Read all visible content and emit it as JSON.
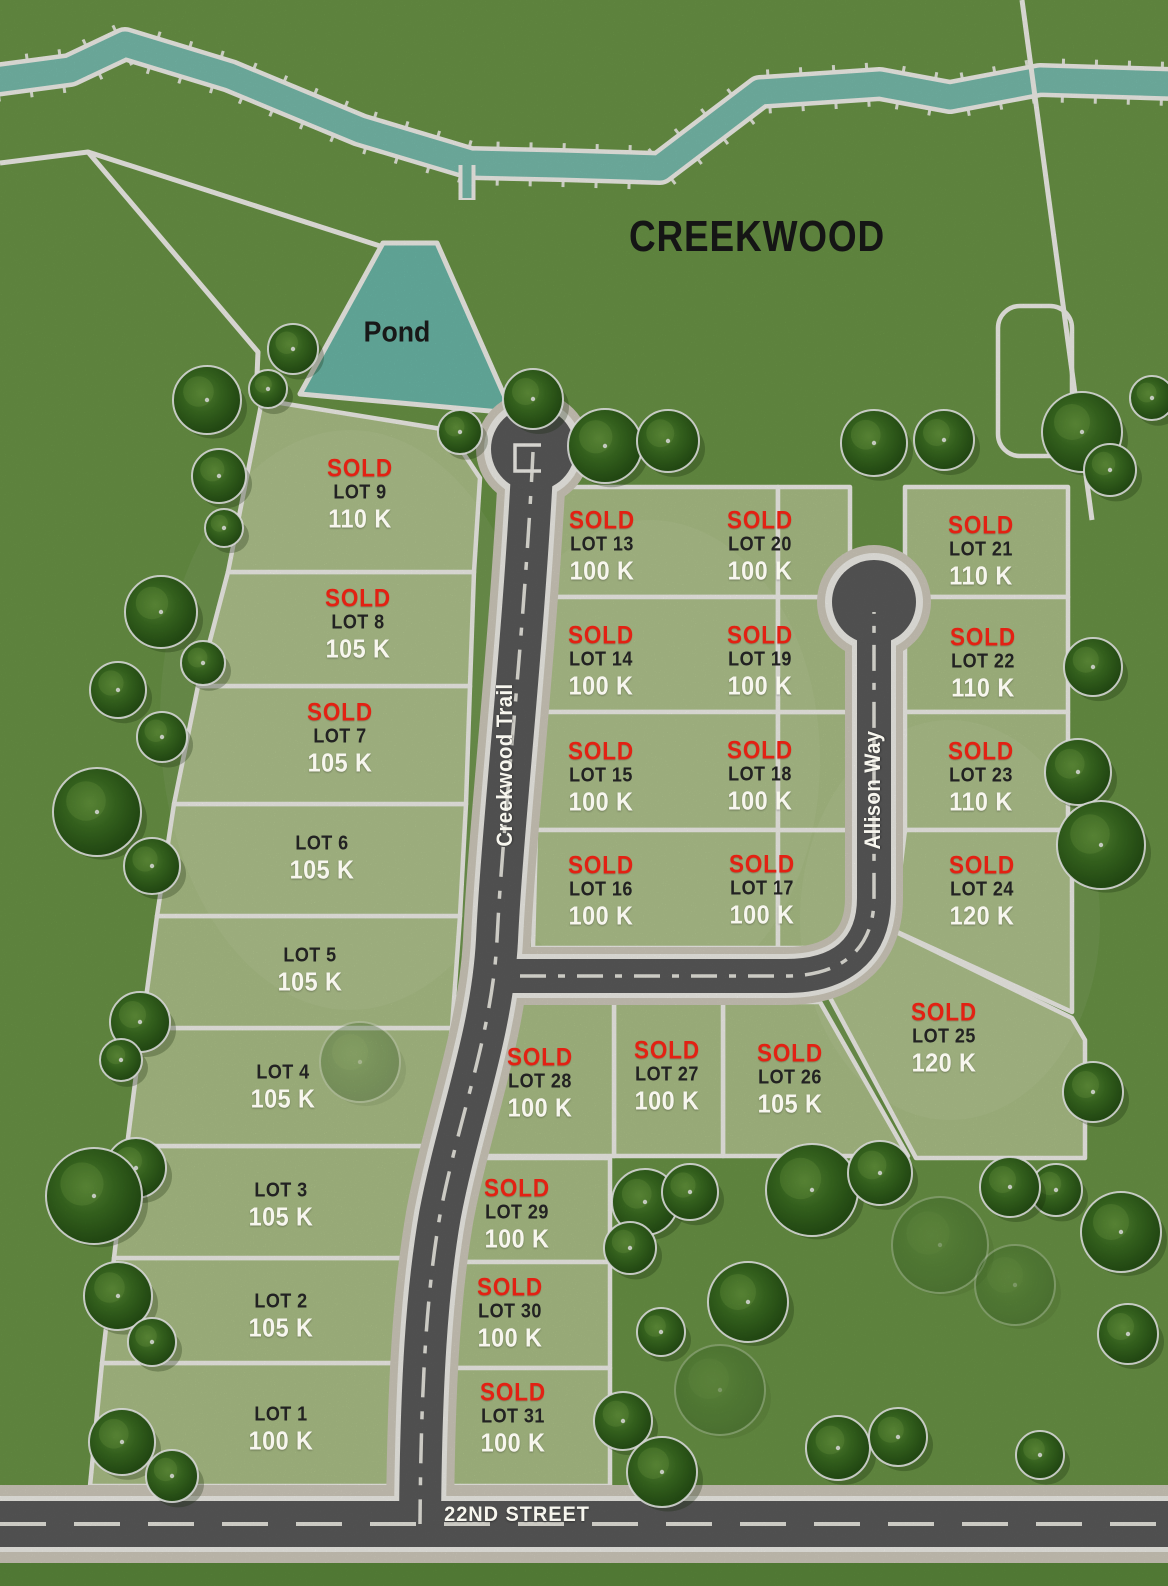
{
  "title": "CREEKWOOD",
  "pond": {
    "label": "Pond"
  },
  "streets": [
    {
      "name": "Creekwood Trail"
    },
    {
      "name": "Allison Way"
    },
    {
      "name": "22ND STREET"
    }
  ],
  "sold_label": "SOLD",
  "lots": [
    {
      "id": "lot-1",
      "name": "LOT 1",
      "price": "100 K",
      "sold": false
    },
    {
      "id": "lot-2",
      "name": "LOT 2",
      "price": "105 K",
      "sold": false
    },
    {
      "id": "lot-3",
      "name": "LOT 3",
      "price": "105 K",
      "sold": false
    },
    {
      "id": "lot-4",
      "name": "LOT 4",
      "price": "105 K",
      "sold": false
    },
    {
      "id": "lot-5",
      "name": "LOT 5",
      "price": "105 K",
      "sold": false
    },
    {
      "id": "lot-6",
      "name": "LOT 6",
      "price": "105 K",
      "sold": false
    },
    {
      "id": "lot-7",
      "name": "LOT 7",
      "price": "105 K",
      "sold": true
    },
    {
      "id": "lot-8",
      "name": "LOT 8",
      "price": "105 K",
      "sold": true
    },
    {
      "id": "lot-9",
      "name": "LOT 9",
      "price": "110 K",
      "sold": true
    },
    {
      "id": "lot-13",
      "name": "LOT 13",
      "price": "100 K",
      "sold": true
    },
    {
      "id": "lot-14",
      "name": "LOT 14",
      "price": "100 K",
      "sold": true
    },
    {
      "id": "lot-15",
      "name": "LOT 15",
      "price": "100 K",
      "sold": true
    },
    {
      "id": "lot-16",
      "name": "LOT 16",
      "price": "100 K",
      "sold": true
    },
    {
      "id": "lot-17",
      "name": "LOT 17",
      "price": "100 K",
      "sold": true
    },
    {
      "id": "lot-18",
      "name": "LOT 18",
      "price": "100 K",
      "sold": true
    },
    {
      "id": "lot-19",
      "name": "LOT 19",
      "price": "100 K",
      "sold": true
    },
    {
      "id": "lot-20",
      "name": "LOT 20",
      "price": "100 K",
      "sold": true
    },
    {
      "id": "lot-21",
      "name": "LOT 21",
      "price": "110 K",
      "sold": true
    },
    {
      "id": "lot-22",
      "name": "LOT 22",
      "price": "110 K",
      "sold": true
    },
    {
      "id": "lot-23",
      "name": "LOT 23",
      "price": "110 K",
      "sold": true
    },
    {
      "id": "lot-24",
      "name": "LOT 24",
      "price": "120 K",
      "sold": true
    },
    {
      "id": "lot-25",
      "name": "LOT 25",
      "price": "120 K",
      "sold": true
    },
    {
      "id": "lot-26",
      "name": "LOT 26",
      "price": "105 K",
      "sold": true
    },
    {
      "id": "lot-27",
      "name": "LOT 27",
      "price": "100 K",
      "sold": true
    },
    {
      "id": "lot-28",
      "name": "LOT 28",
      "price": "100 K",
      "sold": true
    },
    {
      "id": "lot-29",
      "name": "LOT 29",
      "price": "100 K",
      "sold": true
    },
    {
      "id": "lot-30",
      "name": "LOT 30",
      "price": "100 K",
      "sold": true
    },
    {
      "id": "lot-31",
      "name": "LOT 31",
      "price": "100 K",
      "sold": true
    }
  ],
  "colors": {
    "grass": "#6e9a49",
    "lot_fill": "#b3c88d",
    "road": "#5e5e5e",
    "sidewalk": "#d8d3c4",
    "water": "#7cc3b3",
    "sold_red": "#e32113",
    "price_white": "#f7f6ee",
    "lot_text": "#222222",
    "line_white": "#fcfbf5"
  }
}
